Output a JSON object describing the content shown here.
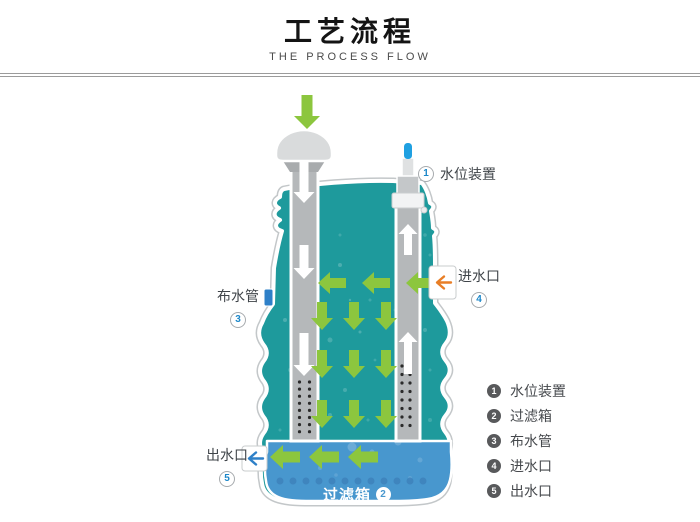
{
  "header": {
    "title": "工艺流程",
    "subtitle": "THE PROCESS FLOW"
  },
  "diagram": {
    "callouts": {
      "water_level": {
        "num": "1",
        "label": "水位装置"
      },
      "filter_box": {
        "num": "2",
        "label": "过滤箱"
      },
      "distribution_pipe": {
        "num": "3",
        "label": "布水管"
      },
      "inlet": {
        "num": "4",
        "label": "进水口"
      },
      "outlet": {
        "num": "5",
        "label": "出水口"
      }
    },
    "legend": [
      {
        "num": "1",
        "label": "水位装置"
      },
      {
        "num": "2",
        "label": "过滤箱"
      },
      {
        "num": "3",
        "label": "布水管"
      },
      {
        "num": "4",
        "label": "进水口"
      },
      {
        "num": "5",
        "label": "出水口"
      }
    ],
    "colors": {
      "tank_water": "#1E9A9C",
      "filter_box": "#4897CE",
      "flow_arrow_green": "#8CC63E",
      "inlet_arrow_orange": "#E87E26",
      "outlet_arrow_blue": "#2E80C8",
      "pipe_gray": "#B5B8BA",
      "device_blue": "#1FA0E1"
    }
  }
}
